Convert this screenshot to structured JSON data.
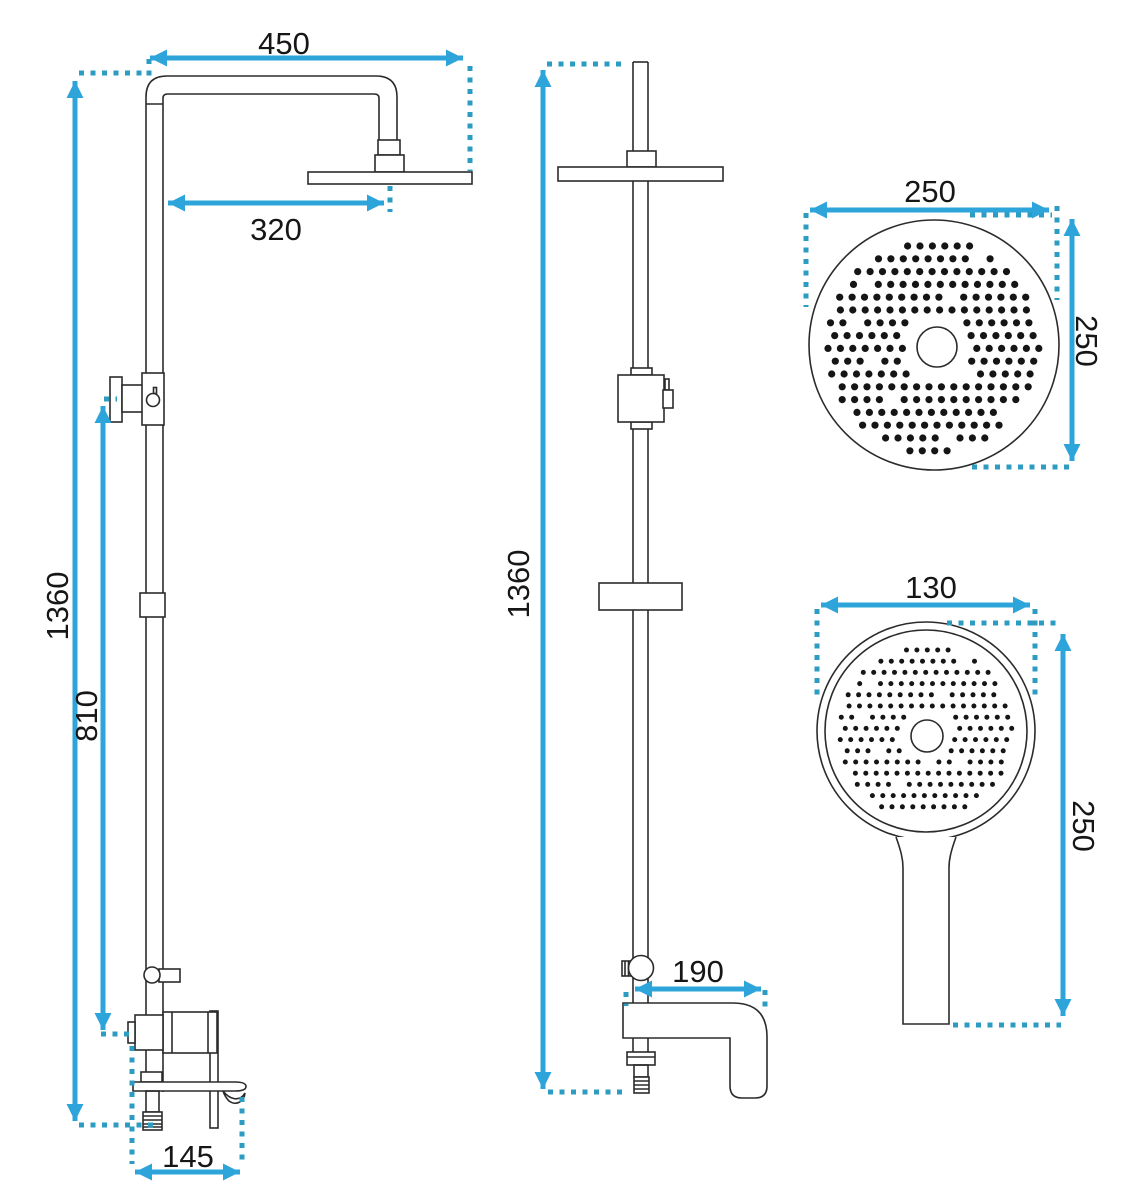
{
  "drawing_title": "shower-set-technical-drawing",
  "colors": {
    "outline": "#2b2b2b",
    "dimension_blue": "#2da4da",
    "extension_dash_blue": "#2d9cc2",
    "text": "#161616",
    "background": "#ffffff",
    "spray_dot": "#151515"
  },
  "views": {
    "front": {
      "name": "front-elevation",
      "dims": {
        "arm_reach": "450",
        "head_offset": "320",
        "total_height": "1360",
        "bracket_height": "810",
        "base_width": "145"
      }
    },
    "side": {
      "name": "side-elevation",
      "dims": {
        "total_height": "1360",
        "spout_reach": "190"
      }
    },
    "rain_head": {
      "name": "rain-shower-head-face",
      "dims": {
        "width": "250",
        "height": "250"
      }
    },
    "hand_shower": {
      "name": "hand-shower-face",
      "dims": {
        "width": "130",
        "height": "250"
      }
    }
  },
  "spray_patterns": {
    "rain_head": {
      "cx": 934,
      "cy": 346,
      "clip_r": 108,
      "row_gap": 12.8,
      "col_gap": 12.4,
      "dot_r": 3.6,
      "hole_cx": 937,
      "hole_cy": 347,
      "hole_clear": 33,
      "start_offset": 8
    },
    "hand_shower": {
      "cx": 926,
      "cy": 732,
      "clip_r": 88,
      "row_gap": 11.2,
      "col_gap": 10.4,
      "dot_r": 2.5,
      "hole_cx": 927,
      "hole_cy": 736,
      "hole_clear": 27,
      "start_offset": 6
    }
  }
}
